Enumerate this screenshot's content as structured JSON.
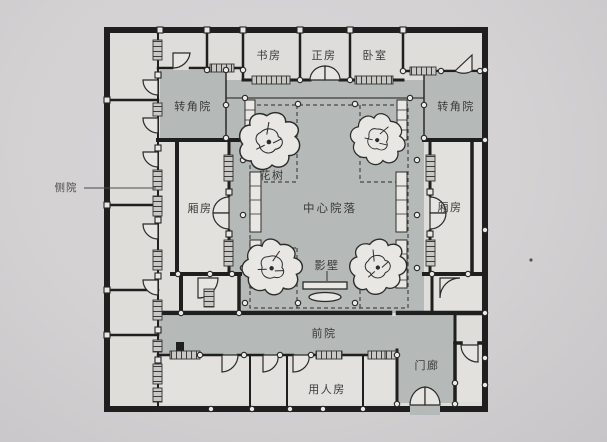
{
  "figure": {
    "type": "architectural-floor-plan",
    "subject": "Chinese siheyuan courtyard residence plan, photographed book page"
  },
  "colors": {
    "paper": "#d3d1d2",
    "courtyard_fill": "#b5b9b8",
    "room_fill": "#e2e1dd",
    "wall": "#1f1f1f",
    "label_text": "#3a3a3a"
  },
  "plan": {
    "rooms": {
      "study": "书房",
      "main_hall": "正房",
      "bedroom": "卧室",
      "corner_courtyard_left": "转角院",
      "corner_courtyard_right": "转角院",
      "side_courtyard": "侧院",
      "wing_room_left": "厢房",
      "wing_room_right": "厢房",
      "flower_tree": "花树",
      "central_courtyard": "中心院落",
      "screen_wall": "影壁",
      "front_courtyard": "前院",
      "servants_room": "用人房",
      "porch": "门廊"
    }
  }
}
